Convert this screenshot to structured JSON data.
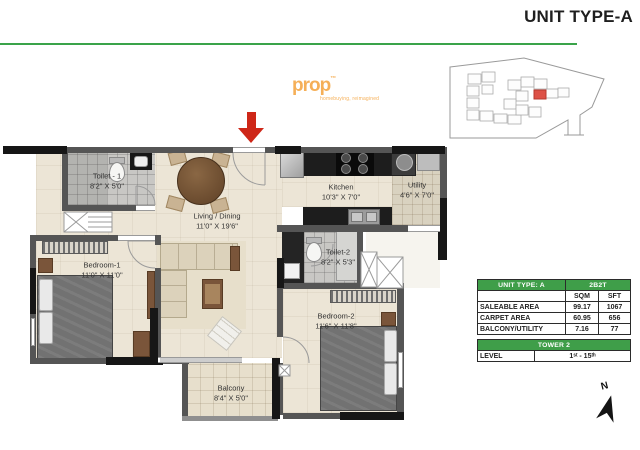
{
  "title": "UNIT TYPE-A",
  "watermark": {
    "brand": "prop",
    "tm": "™",
    "tagline": "homebuying, reimagined"
  },
  "plan": {
    "rooms": {
      "toilet1": {
        "name": "Toilet - 1",
        "dims": "8'2\" X 5'0\""
      },
      "living": {
        "name": "Living / Dining",
        "dims": "11'0\" X 19'6\""
      },
      "kitchen": {
        "name": "Kitchen",
        "dims": "10'3\" X 7'0\""
      },
      "utility": {
        "name": "Utility",
        "dims": "4'6\" X 7'0\""
      },
      "toilet2": {
        "name": "Toilet-2",
        "dims": "8'2\" X 5'3\""
      },
      "bedroom1": {
        "name": "Bedroom-1",
        "dims": "11'0\" X 11'0\""
      },
      "bedroom2": {
        "name": "Bedroom-2",
        "dims": "11'6\" X 11'8\""
      },
      "balcony": {
        "name": "Balcony",
        "dims": "8'4\" X 5'0\""
      }
    }
  },
  "area_table": {
    "unit_type": "UNIT TYPE: A",
    "config": "2B2T",
    "col_sqm": "SQM",
    "col_sft": "SFT",
    "rows": [
      {
        "label": "SALEABLE AREA",
        "sqm": "99.17",
        "sft": "1067"
      },
      {
        "label": "CARPET AREA",
        "sqm": "60.95",
        "sft": "656"
      },
      {
        "label": "BALCONY/UTILITY",
        "sqm": "7.16",
        "sft": "77"
      }
    ]
  },
  "tower_table": {
    "title": "TOWER 2",
    "level_label": "LEVEL",
    "level_value": "1ˢᵗ - 15ᵗʰ"
  },
  "compass": {
    "label": "N"
  },
  "colors": {
    "accent_green": "#3aa34a",
    "arrow_red": "#ce2718",
    "highlight_red": "#dd5146",
    "wall": "#555555",
    "watermark_orange": "#f39c2f"
  }
}
